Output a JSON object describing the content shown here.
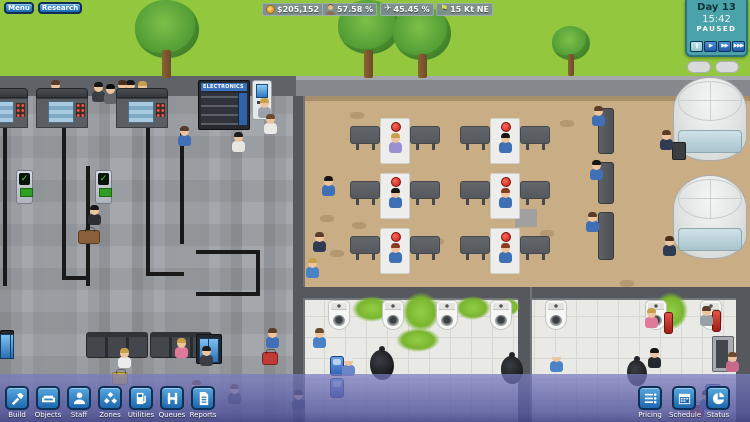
{
  "hud": {
    "menu_button": "Menu",
    "research_button": "Research",
    "stats": [
      {
        "icon": "coin-icon",
        "value": "$205,152"
      },
      {
        "icon": "passenger-icon",
        "value": "57.58 %"
      },
      {
        "icon": "plane-icon",
        "value": "45.45 %",
        "glyph": "✈"
      },
      {
        "icon": "wind-flag-icon",
        "value": "15 Kt NE",
        "glyph": "⚑",
        "glyph_color": "#d6e04a"
      }
    ],
    "clock": {
      "day": "Day 13",
      "time": "15:42",
      "state": "PAUSED",
      "speed_buttons": [
        {
          "name": "pause",
          "glyph": "‖"
        },
        {
          "name": "play",
          "glyph": "▶"
        },
        {
          "name": "fast-forward",
          "glyph": "▶▶"
        },
        {
          "name": "fastest-forward",
          "glyph": "▶▶▶"
        }
      ]
    },
    "toolbar_left": [
      {
        "label": "Build",
        "icon": "hammer-icon"
      },
      {
        "label": "Objects",
        "icon": "sofa-icon"
      },
      {
        "label": "Staff",
        "icon": "person-icon"
      },
      {
        "label": "Zones",
        "icon": "diamonds-icon"
      },
      {
        "label": "Utilities",
        "icon": "fuel-pump-icon"
      },
      {
        "label": "Queues",
        "icon": "stanchion-icon"
      },
      {
        "label": "Reports",
        "icon": "document-icon"
      }
    ],
    "toolbar_right": [
      {
        "label": "Pricing",
        "icon": "price-list-icon"
      },
      {
        "label": "Schedule",
        "icon": "calendar-icon"
      },
      {
        "label": "Status",
        "icon": "pie-chart-icon"
      }
    ]
  },
  "scene": {
    "vending_label": "ELECTRONICS",
    "colors": {
      "grass": "#93c73e",
      "road": "#85888c",
      "floor_left": "#a4a7ab",
      "floor_tan": "#c9ad85",
      "floor_bath": "#e9e9e5",
      "wall": "#55585c",
      "queue_line": "#191919",
      "hud_blue": "#1e68ad",
      "clock_teal": "#4aa3ab",
      "toolbar_purple": "#5a5ca0",
      "goo_green": "#85c23a"
    },
    "objects": [
      {
        "t": "tree-c",
        "x": 135,
        "y": 0,
        "w": 64,
        "h": 58
      },
      {
        "t": "tree-c",
        "x": 338,
        "y": 0,
        "w": 62,
        "h": 54
      },
      {
        "t": "tree-c",
        "x": 393,
        "y": 6,
        "w": 58,
        "h": 54
      },
      {
        "t": "tree-c",
        "x": 552,
        "y": 26,
        "w": 38,
        "h": 34
      },
      {
        "t": "tree-t",
        "x": 162,
        "y": 50,
        "w": 9,
        "h": 28
      },
      {
        "t": "tree-t",
        "x": 364,
        "y": 50,
        "w": 9,
        "h": 28
      },
      {
        "t": "tree-t",
        "x": 418,
        "y": 54,
        "w": 9,
        "h": 24
      },
      {
        "t": "tree-t",
        "x": 568,
        "y": 54,
        "w": 6,
        "h": 22
      },
      {
        "t": "vent",
        "x": 687,
        "y": 61,
        "w": 24,
        "h": 12
      },
      {
        "t": "vent",
        "x": 715,
        "y": 61,
        "w": 24,
        "h": 12
      },
      {
        "t": "qline",
        "x": 3,
        "y": 128,
        "w": 4,
        "h": 158
      },
      {
        "t": "qline",
        "x": 62,
        "y": 128,
        "w": 4,
        "h": 152
      },
      {
        "t": "qline",
        "x": 86,
        "y": 166,
        "w": 4,
        "h": 120
      },
      {
        "t": "qline",
        "x": 62,
        "y": 276,
        "w": 28,
        "h": 4
      },
      {
        "t": "qline",
        "x": 146,
        "y": 128,
        "w": 4,
        "h": 148
      },
      {
        "t": "qline",
        "x": 180,
        "y": 128,
        "w": 4,
        "h": 116
      },
      {
        "t": "qline",
        "x": 146,
        "y": 272,
        "w": 38,
        "h": 4
      },
      {
        "t": "qline",
        "x": 196,
        "y": 250,
        "w": 64,
        "h": 4
      },
      {
        "t": "qline",
        "x": 256,
        "y": 250,
        "w": 4,
        "h": 46
      },
      {
        "t": "qline",
        "x": 196,
        "y": 292,
        "w": 62,
        "h": 4
      },
      {
        "t": "fleck",
        "x": 320,
        "y": 215
      },
      {
        "t": "fleck",
        "x": 352,
        "y": 222
      },
      {
        "t": "fleck",
        "x": 388,
        "y": 230
      },
      {
        "t": "fleck",
        "x": 430,
        "y": 238
      },
      {
        "t": "fleck",
        "x": 470,
        "y": 246
      },
      {
        "t": "fleck",
        "x": 330,
        "y": 250
      },
      {
        "t": "fleck",
        "x": 540,
        "y": 230
      },
      {
        "t": "fleck",
        "x": 560,
        "y": 120
      },
      {
        "t": "fleck",
        "x": 620,
        "y": 280
      },
      {
        "t": "fleck",
        "x": 350,
        "y": 112
      },
      {
        "t": "gray-patch",
        "x": 515,
        "y": 209,
        "w": 22,
        "h": 18
      },
      {
        "t": "goo",
        "x": 352,
        "y": 296,
        "w": 40,
        "h": 26
      },
      {
        "t": "goo",
        "x": 402,
        "y": 292,
        "w": 38,
        "h": 40
      },
      {
        "t": "goo",
        "x": 455,
        "y": 296,
        "w": 36,
        "h": 24
      },
      {
        "t": "goo",
        "x": 496,
        "y": 298,
        "w": 24,
        "h": 18
      },
      {
        "t": "goo",
        "x": 396,
        "y": 328,
        "w": 44,
        "h": 24
      },
      {
        "t": "goo",
        "x": 654,
        "y": 292,
        "w": 34,
        "h": 38
      },
      {
        "t": "person",
        "x": 49,
        "y": 89,
        "s": "#2f3b52",
        "hr": "#5a3c28"
      },
      {
        "t": "person",
        "x": 124,
        "y": 89,
        "s": "#2f3b52",
        "hr": "#161616"
      },
      {
        "t": "person",
        "x": 136,
        "y": 90,
        "s": "#3f6fb5",
        "hr": "#c9a04a"
      },
      {
        "t": "person",
        "x": 92,
        "y": 91,
        "s": "#3a3f46",
        "hr": "#161616"
      },
      {
        "t": "person",
        "x": 104,
        "y": 93,
        "s": "#61666d",
        "hr": "#0d0d0d"
      },
      {
        "t": "person",
        "x": 116,
        "y": 89,
        "s": "#30343a",
        "hr": "#4a2f1d"
      },
      {
        "t": "sec-desk",
        "x": -16,
        "y": 88,
        "w": 44,
        "h": 10
      },
      {
        "t": "xray",
        "x": -16,
        "y": 98,
        "w": 44,
        "h": 30
      },
      {
        "t": "sec-desk",
        "x": 36,
        "y": 88,
        "w": 52,
        "h": 10
      },
      {
        "t": "xray",
        "x": 36,
        "y": 98,
        "w": 52,
        "h": 30
      },
      {
        "t": "sec-desk",
        "x": 116,
        "y": 88,
        "w": 52,
        "h": 10
      },
      {
        "t": "xray",
        "x": 116,
        "y": 98,
        "w": 52,
        "h": 30
      },
      {
        "t": "scanner",
        "x": 16,
        "y": 170,
        "w": 17,
        "h": 34
      },
      {
        "t": "scanner",
        "x": 95,
        "y": 170,
        "w": 17,
        "h": 34
      },
      {
        "t": "slab-h",
        "x": 350,
        "y": 126
      },
      {
        "t": "slab-h",
        "x": 410,
        "y": 126
      },
      {
        "t": "desk-white",
        "x": 380,
        "y": 118
      },
      {
        "t": "slab-h",
        "x": 460,
        "y": 126
      },
      {
        "t": "slab-h",
        "x": 520,
        "y": 126
      },
      {
        "t": "desk-white",
        "x": 490,
        "y": 118
      },
      {
        "t": "slab-h",
        "x": 350,
        "y": 181
      },
      {
        "t": "slab-h",
        "x": 410,
        "y": 181
      },
      {
        "t": "desk-white",
        "x": 380,
        "y": 173
      },
      {
        "t": "slab-h",
        "x": 460,
        "y": 181
      },
      {
        "t": "slab-h",
        "x": 520,
        "y": 181
      },
      {
        "t": "desk-white",
        "x": 490,
        "y": 173
      },
      {
        "t": "slab-h",
        "x": 350,
        "y": 236
      },
      {
        "t": "slab-h",
        "x": 410,
        "y": 236
      },
      {
        "t": "desk-white",
        "x": 380,
        "y": 228
      },
      {
        "t": "slab-h",
        "x": 460,
        "y": 236
      },
      {
        "t": "slab-h",
        "x": 520,
        "y": 236
      },
      {
        "t": "desk-white",
        "x": 490,
        "y": 228
      },
      {
        "t": "vbench",
        "x": 598,
        "y": 108,
        "w": 16,
        "h": 46
      },
      {
        "t": "vbench",
        "x": 598,
        "y": 162,
        "w": 16,
        "h": 42
      },
      {
        "t": "vbench",
        "x": 598,
        "y": 212,
        "w": 16,
        "h": 48
      },
      {
        "t": "tower",
        "x": 673,
        "y": 77,
        "w": 74,
        "h": 84
      },
      {
        "t": "tower",
        "x": 673,
        "y": 175,
        "w": 74,
        "h": 84
      },
      {
        "t": "bench",
        "x": 86,
        "y": 332,
        "w": 62,
        "h": 26
      },
      {
        "t": "bench",
        "x": 150,
        "y": 332,
        "w": 62,
        "h": 26
      },
      {
        "t": "board",
        "x": 196,
        "y": 334,
        "w": 26,
        "h": 30
      },
      {
        "t": "board",
        "x": 0,
        "y": 330,
        "w": 14,
        "h": 28
      },
      {
        "t": "atm",
        "x": 252,
        "y": 80,
        "w": 20,
        "h": 40
      },
      {
        "t": "toilet",
        "x": 328,
        "y": 300
      },
      {
        "t": "toilet",
        "x": 382,
        "y": 300
      },
      {
        "t": "toilet",
        "x": 436,
        "y": 300
      },
      {
        "t": "toilet",
        "x": 490,
        "y": 300
      },
      {
        "t": "toilet",
        "x": 545,
        "y": 300
      },
      {
        "t": "toilet",
        "x": 645,
        "y": 300
      },
      {
        "t": "toilet",
        "x": 700,
        "y": 300
      },
      {
        "t": "vending-gray",
        "x": 712,
        "y": 336,
        "w": 22,
        "h": 36
      },
      {
        "t": "wall-sink",
        "x": 330,
        "y": 356,
        "w": 14,
        "h": 20
      },
      {
        "t": "wall-sink",
        "x": 330,
        "y": 378,
        "w": 14,
        "h": 20
      },
      {
        "t": "wall-sink",
        "x": 705,
        "y": 384,
        "w": 16,
        "h": 26
      },
      {
        "t": "bin",
        "x": 664,
        "y": 312,
        "w": 9,
        "h": 22
      },
      {
        "t": "bin",
        "x": 712,
        "y": 310,
        "w": 9,
        "h": 22
      },
      {
        "t": "cart",
        "x": 672,
        "y": 142,
        "w": 14,
        "h": 18
      },
      {
        "t": "trash-bag",
        "x": 370,
        "y": 350,
        "w": 24,
        "h": 30
      },
      {
        "t": "trash-bag",
        "x": 501,
        "y": 356,
        "w": 22,
        "h": 28
      },
      {
        "t": "trash-bag",
        "x": 627,
        "y": 360,
        "w": 20,
        "h": 26
      },
      {
        "t": "case",
        "x": 78,
        "y": 230,
        "w": 22,
        "h": 14,
        "c": "#8a5f3a"
      },
      {
        "t": "case",
        "x": 112,
        "y": 372,
        "w": 16,
        "h": 13,
        "c": "#d9b23a"
      },
      {
        "t": "case",
        "x": 262,
        "y": 352,
        "w": 16,
        "h": 13,
        "c": "#c23a35"
      },
      {
        "t": "case",
        "x": 690,
        "y": 405,
        "w": 14,
        "h": 12,
        "c": "#c23a35"
      },
      {
        "t": "person",
        "x": 389,
        "y": 142,
        "s": "#9a8fd0",
        "hr": "#c9a04a"
      },
      {
        "t": "person",
        "x": 499,
        "y": 142,
        "s": "#3f6fb5",
        "hr": "#161616"
      },
      {
        "t": "person",
        "x": 389,
        "y": 197,
        "s": "#3f6fb5",
        "hr": "#161616"
      },
      {
        "t": "person",
        "x": 499,
        "y": 197,
        "s": "#3f6fb5",
        "hr": "#8a3b22"
      },
      {
        "t": "person",
        "x": 389,
        "y": 252,
        "s": "#3f6fb5",
        "hr": "#8a3b22"
      },
      {
        "t": "person",
        "x": 499,
        "y": 252,
        "s": "#3f6fb5",
        "hr": "#8a3b22"
      },
      {
        "t": "person",
        "x": 178,
        "y": 135,
        "s": "#3f6fb5",
        "hr": "#5a3c28"
      },
      {
        "t": "person",
        "x": 88,
        "y": 214,
        "s": "#2b2e35",
        "hr": "#161616"
      },
      {
        "t": "person",
        "x": 232,
        "y": 141,
        "s": "#e8e6e2",
        "hr": "#1c1c1c"
      },
      {
        "t": "person",
        "x": 258,
        "y": 107,
        "s": "#9aa2ab",
        "hr": "#c9a04a"
      },
      {
        "t": "person",
        "x": 264,
        "y": 123,
        "s": "#eceae6",
        "hr": "#6b4a2e"
      },
      {
        "t": "person",
        "x": 118,
        "y": 357,
        "s": "#ececec",
        "hr": "#c9a04a"
      },
      {
        "t": "person",
        "x": 175,
        "y": 347,
        "s": "#e07a9a",
        "hr": "#c9a04a"
      },
      {
        "t": "person",
        "x": 200,
        "y": 355,
        "s": "#3a3d44",
        "hr": "#1c1c1c"
      },
      {
        "t": "person",
        "x": 190,
        "y": 389,
        "s": "#5a9e4a",
        "hr": "#5a3c28"
      },
      {
        "t": "person",
        "x": 228,
        "y": 393,
        "s": "#44484f",
        "hr": "#5a3c28"
      },
      {
        "t": "person",
        "x": 266,
        "y": 337,
        "s": "#3f6fb5",
        "hr": "#5a3c28"
      },
      {
        "t": "person",
        "x": 322,
        "y": 185,
        "s": "#3f6fb5",
        "hr": "#161616"
      },
      {
        "t": "person",
        "x": 313,
        "y": 241,
        "s": "#2f3b52",
        "hr": "#5a3c28"
      },
      {
        "t": "person",
        "x": 306,
        "y": 267,
        "s": "#4a82c8",
        "hr": "#c9a04a"
      },
      {
        "t": "person",
        "x": 592,
        "y": 115,
        "s": "#3f6fb5",
        "hr": "#5a3c28"
      },
      {
        "t": "person",
        "x": 590,
        "y": 169,
        "s": "#3f6fb5",
        "hr": "#161616"
      },
      {
        "t": "person",
        "x": 586,
        "y": 221,
        "s": "#3f6fb5",
        "hr": "#5a3c28"
      },
      {
        "t": "person",
        "x": 660,
        "y": 139,
        "s": "#2f3b52",
        "hr": "#5a3c28"
      },
      {
        "t": "person",
        "x": 663,
        "y": 245,
        "s": "#2f3b52",
        "hr": "#4a2f1d"
      },
      {
        "t": "person",
        "x": 313,
        "y": 337,
        "s": "#4a82c8",
        "hr": "#6b4a2e"
      },
      {
        "t": "person",
        "x": 342,
        "y": 365,
        "s": "#6b86c8",
        "hr": "#e8e8e8"
      },
      {
        "t": "person",
        "x": 645,
        "y": 317,
        "s": "#e07a9a",
        "hr": "#c9a04a"
      },
      {
        "t": "person",
        "x": 700,
        "y": 315,
        "s": "#9aa0a8",
        "hr": "#5a3c28"
      },
      {
        "t": "person",
        "x": 648,
        "y": 357,
        "s": "#26292e",
        "hr": "#161616"
      },
      {
        "t": "person",
        "x": 726,
        "y": 361,
        "s": "#c86a8a",
        "hr": "#6b4a2e"
      },
      {
        "t": "person",
        "x": 550,
        "y": 361,
        "s": "#4a82c8",
        "hr": "#e8e8e8"
      },
      {
        "t": "person",
        "x": 700,
        "y": 399,
        "s": "#3f6fb5",
        "hr": "#1c1c1c"
      },
      {
        "t": "person",
        "x": 292,
        "y": 399,
        "s": "#2f3b52",
        "hr": "#161616"
      }
    ]
  }
}
